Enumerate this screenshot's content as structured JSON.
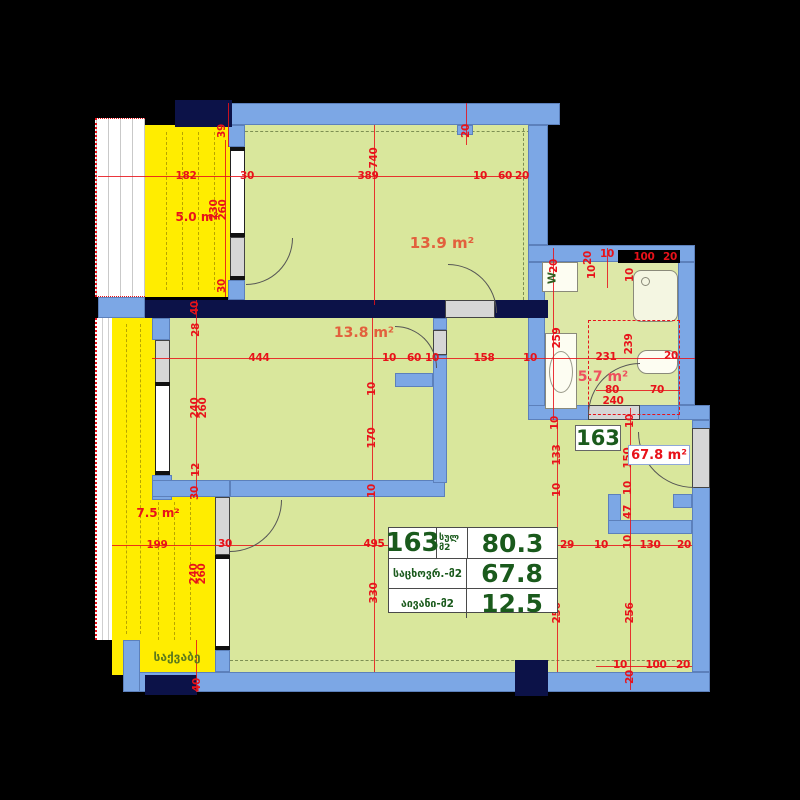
{
  "plan_title": "apartment-floor-plan-163",
  "unit": {
    "number": "163",
    "area_label": "67.8 m²"
  },
  "table": {
    "unit_number": "163",
    "total_label": "სულ",
    "total_unit": "მ2",
    "total_value": "80.3",
    "living_label": "საცხოვრ.-მ2",
    "living_value": "67.8",
    "balcony_label": "აივანი-მ2",
    "balcony_value": "12.5"
  },
  "annotations": {
    "washer": "W",
    "boiler_room": "საქვაბე"
  },
  "rooms": [
    {
      "id": "balcony-top-left",
      "label": "5.0 m²",
      "x": 197,
      "y": 217,
      "color": "#e8121a",
      "fs": 12
    },
    {
      "id": "room-top",
      "label": "13.9 m²",
      "x": 442,
      "y": 243,
      "color": "#e2603d",
      "fs": 15
    },
    {
      "id": "room-middle",
      "label": "13.8 m²",
      "x": 364,
      "y": 333,
      "color": "#e2603d",
      "fs": 14
    },
    {
      "id": "bathroom",
      "label": "5.7 m²",
      "x": 603,
      "y": 377,
      "color": "#ee4f5e",
      "fs": 14
    },
    {
      "id": "balcony-bottom-left",
      "label": "7.5 m²",
      "x": 158,
      "y": 513,
      "color": "#e8121a",
      "fs": 12
    }
  ],
  "dimensions": [
    {
      "t": "39",
      "x": 222,
      "y": 131,
      "v": 1
    },
    {
      "t": "182",
      "x": 186,
      "y": 176,
      "v": 0
    },
    {
      "t": "30",
      "x": 247,
      "y": 176,
      "v": 0
    },
    {
      "t": "389",
      "x": 368,
      "y": 176,
      "v": 0
    },
    {
      "t": "740",
      "x": 374,
      "y": 158,
      "v": 1
    },
    {
      "t": "10",
      "x": 480,
      "y": 176,
      "v": 0
    },
    {
      "t": "60",
      "x": 505,
      "y": 176,
      "v": 0
    },
    {
      "t": "20",
      "x": 522,
      "y": 176,
      "v": 0
    },
    {
      "t": "20",
      "x": 466,
      "y": 131,
      "v": 1
    },
    {
      "t": "230",
      "x": 214,
      "y": 210,
      "v": 1
    },
    {
      "t": "260",
      "x": 223,
      "y": 210,
      "v": 1
    },
    {
      "t": "30",
      "x": 222,
      "y": 286,
      "v": 1
    },
    {
      "t": "40",
      "x": 195,
      "y": 308,
      "v": 1
    },
    {
      "t": "28",
      "x": 196,
      "y": 330,
      "v": 1
    },
    {
      "t": "444",
      "x": 259,
      "y": 358,
      "v": 0
    },
    {
      "t": "240",
      "x": 195,
      "y": 408,
      "v": 1
    },
    {
      "t": "260",
      "x": 203,
      "y": 408,
      "v": 1
    },
    {
      "t": "12",
      "x": 196,
      "y": 470,
      "v": 1
    },
    {
      "t": "30",
      "x": 195,
      "y": 493,
      "v": 1
    },
    {
      "t": "10",
      "x": 389,
      "y": 358,
      "v": 0
    },
    {
      "t": "60",
      "x": 414,
      "y": 358,
      "v": 0
    },
    {
      "t": "10",
      "x": 432,
      "y": 358,
      "v": 0
    },
    {
      "t": "158",
      "x": 484,
      "y": 358,
      "v": 0
    },
    {
      "t": "10",
      "x": 530,
      "y": 358,
      "v": 0
    },
    {
      "t": "10",
      "x": 372,
      "y": 389,
      "v": 1
    },
    {
      "t": "170",
      "x": 372,
      "y": 438,
      "v": 1
    },
    {
      "t": "10",
      "x": 372,
      "y": 491,
      "v": 1
    },
    {
      "t": "259",
      "x": 557,
      "y": 338,
      "v": 1
    },
    {
      "t": "20",
      "x": 554,
      "y": 266,
      "v": 1
    },
    {
      "t": "20",
      "x": 588,
      "y": 258,
      "v": 1
    },
    {
      "t": "10",
      "x": 592,
      "y": 272,
      "v": 1
    },
    {
      "t": "10",
      "x": 607,
      "y": 254,
      "v": 0
    },
    {
      "t": "10",
      "x": 630,
      "y": 275,
      "v": 1
    },
    {
      "t": "100",
      "x": 644,
      "y": 257,
      "v": 0
    },
    {
      "t": "20",
      "x": 670,
      "y": 257,
      "v": 0
    },
    {
      "t": "231",
      "x": 606,
      "y": 357,
      "v": 0
    },
    {
      "t": "239",
      "x": 629,
      "y": 344,
      "v": 1
    },
    {
      "t": "20",
      "x": 671,
      "y": 356,
      "v": 0
    },
    {
      "t": "80",
      "x": 612,
      "y": 390,
      "v": 0
    },
    {
      "t": "70",
      "x": 657,
      "y": 390,
      "v": 0
    },
    {
      "t": "240",
      "x": 613,
      "y": 401,
      "v": 0
    },
    {
      "t": "10",
      "x": 555,
      "y": 423,
      "v": 1
    },
    {
      "t": "10",
      "x": 630,
      "y": 421,
      "v": 1
    },
    {
      "t": "133",
      "x": 557,
      "y": 455,
      "v": 1
    },
    {
      "t": "10",
      "x": 557,
      "y": 490,
      "v": 1
    },
    {
      "t": "150",
      "x": 628,
      "y": 458,
      "v": 1
    },
    {
      "t": "10",
      "x": 628,
      "y": 488,
      "v": 1
    },
    {
      "t": "47",
      "x": 628,
      "y": 512,
      "v": 1
    },
    {
      "t": "10",
      "x": 628,
      "y": 542,
      "v": 1
    },
    {
      "t": "29",
      "x": 567,
      "y": 545,
      "v": 0
    },
    {
      "t": "10",
      "x": 601,
      "y": 545,
      "v": 0
    },
    {
      "t": "130",
      "x": 650,
      "y": 545,
      "v": 0
    },
    {
      "t": "20",
      "x": 684,
      "y": 545,
      "v": 0
    },
    {
      "t": "256",
      "x": 557,
      "y": 613,
      "v": 1
    },
    {
      "t": "256",
      "x": 630,
      "y": 613,
      "v": 1
    },
    {
      "t": "10",
      "x": 620,
      "y": 665,
      "v": 0
    },
    {
      "t": "100",
      "x": 656,
      "y": 665,
      "v": 0
    },
    {
      "t": "20",
      "x": 683,
      "y": 665,
      "v": 0
    },
    {
      "t": "20",
      "x": 630,
      "y": 677,
      "v": 1
    },
    {
      "t": "495",
      "x": 374,
      "y": 544,
      "v": 0
    },
    {
      "t": "330",
      "x": 374,
      "y": 593,
      "v": 1
    },
    {
      "t": "30",
      "x": 225,
      "y": 544,
      "v": 0
    },
    {
      "t": "199",
      "x": 157,
      "y": 545,
      "v": 0
    },
    {
      "t": "240",
      "x": 194,
      "y": 574,
      "v": 1
    },
    {
      "t": "260",
      "x": 202,
      "y": 574,
      "v": 1
    },
    {
      "t": "40",
      "x": 197,
      "y": 685,
      "v": 1
    },
    {
      "t": "10",
      "x": 516,
      "y": 544,
      "v": 0
    },
    {
      "t": "10",
      "x": 551,
      "y": 541,
      "v": 1
    }
  ],
  "colors": {
    "wall_blue": "#7ca7e5",
    "structure_navy": "#0c1248",
    "room_green": "#d9e79c",
    "balcony_yellow": "#ffed00",
    "dimension_red": "#e8121a",
    "table_green": "#1a5a1c",
    "background": "#000000"
  }
}
